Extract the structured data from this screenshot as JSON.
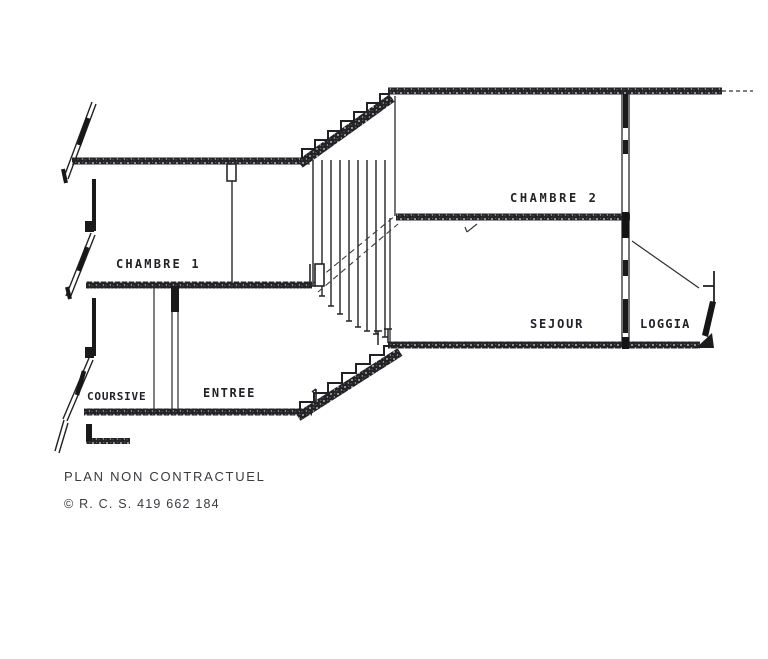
{
  "drawing": {
    "title_type": "building-section-plan",
    "rooms": {
      "chambre1": {
        "label": "CHAMBRE 1"
      },
      "chambre2": {
        "label": "CHAMBRE 2"
      },
      "sejour": {
        "label": "SEJOUR"
      },
      "loggia": {
        "label": "LOGGIA"
      },
      "coursive": {
        "label": "COURSIVE"
      },
      "entree": {
        "label": "ENTREE"
      }
    },
    "colors": {
      "paper": "#ffffff",
      "ink": "#26262a",
      "wall": "#232326"
    }
  },
  "captions": {
    "disclaimer": "PLAN NON CONTRACTUEL",
    "registration": "© R. C. S. 419 662 184"
  }
}
